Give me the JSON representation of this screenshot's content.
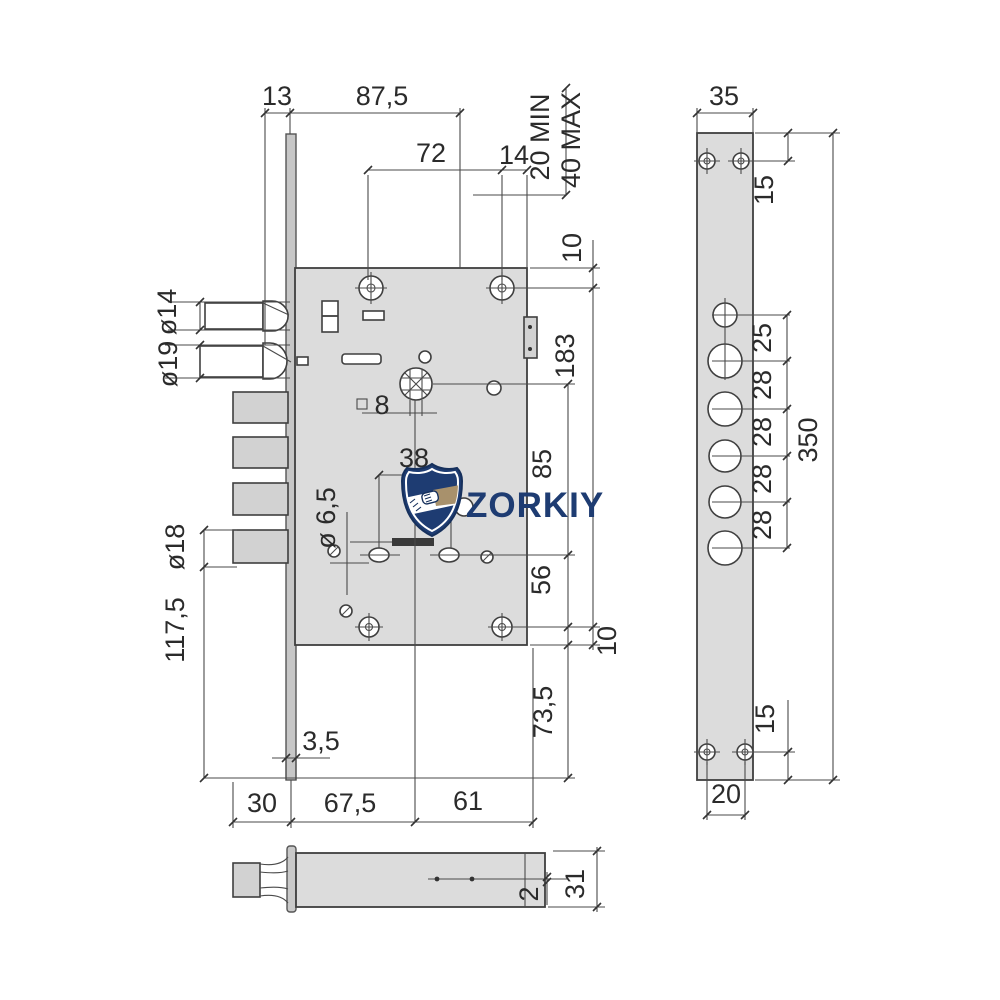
{
  "colors": {
    "navy": "#1e3c72",
    "tan": "#a8916c",
    "line": "#3f3f3f",
    "body_fill": "#dcdcdc",
    "background": "#ffffff"
  },
  "logo": {
    "brand": "ZORKIY",
    "icon": "handshake-shield"
  },
  "front_view": {
    "top": {
      "offset_13": "13",
      "backset_87_5": "87,5",
      "screw_span_72": "72",
      "offset_14": "14",
      "door_min": "20 MIN",
      "door_max": "40 MAX",
      "edge_to_screw_10": "10"
    },
    "right": {
      "screw_span_183": "183",
      "hub_to_holes_85": "85",
      "holes_to_screw_56": "56",
      "screw_to_edge_10": "10",
      "below_body_73_5": "73,5"
    },
    "left": {
      "latch_dia_14": "ø14",
      "latch_dia_19": "ø19",
      "bolt_dia_18": "ø18",
      "bolt_to_base_117_5": "117,5"
    },
    "center": {
      "spindle_square_8": "8",
      "hole_span_38": "38",
      "hole_dia_6_5": "ø 6,5",
      "plate_thickness_3_5": "3,5"
    },
    "bottom": {
      "seg_30": "30",
      "seg_67_5": "67,5",
      "seg_61": "61"
    }
  },
  "faceplate_view": {
    "width_35": "35",
    "top_screw_offset_15": "15",
    "gaps": [
      "25",
      "28",
      "28",
      "28",
      "28"
    ],
    "length_350": "350",
    "bottom_screw_offset_15": "15",
    "screw_spacing_20": "20"
  },
  "side_view": {
    "gap_2": "2",
    "height_31": "31"
  }
}
